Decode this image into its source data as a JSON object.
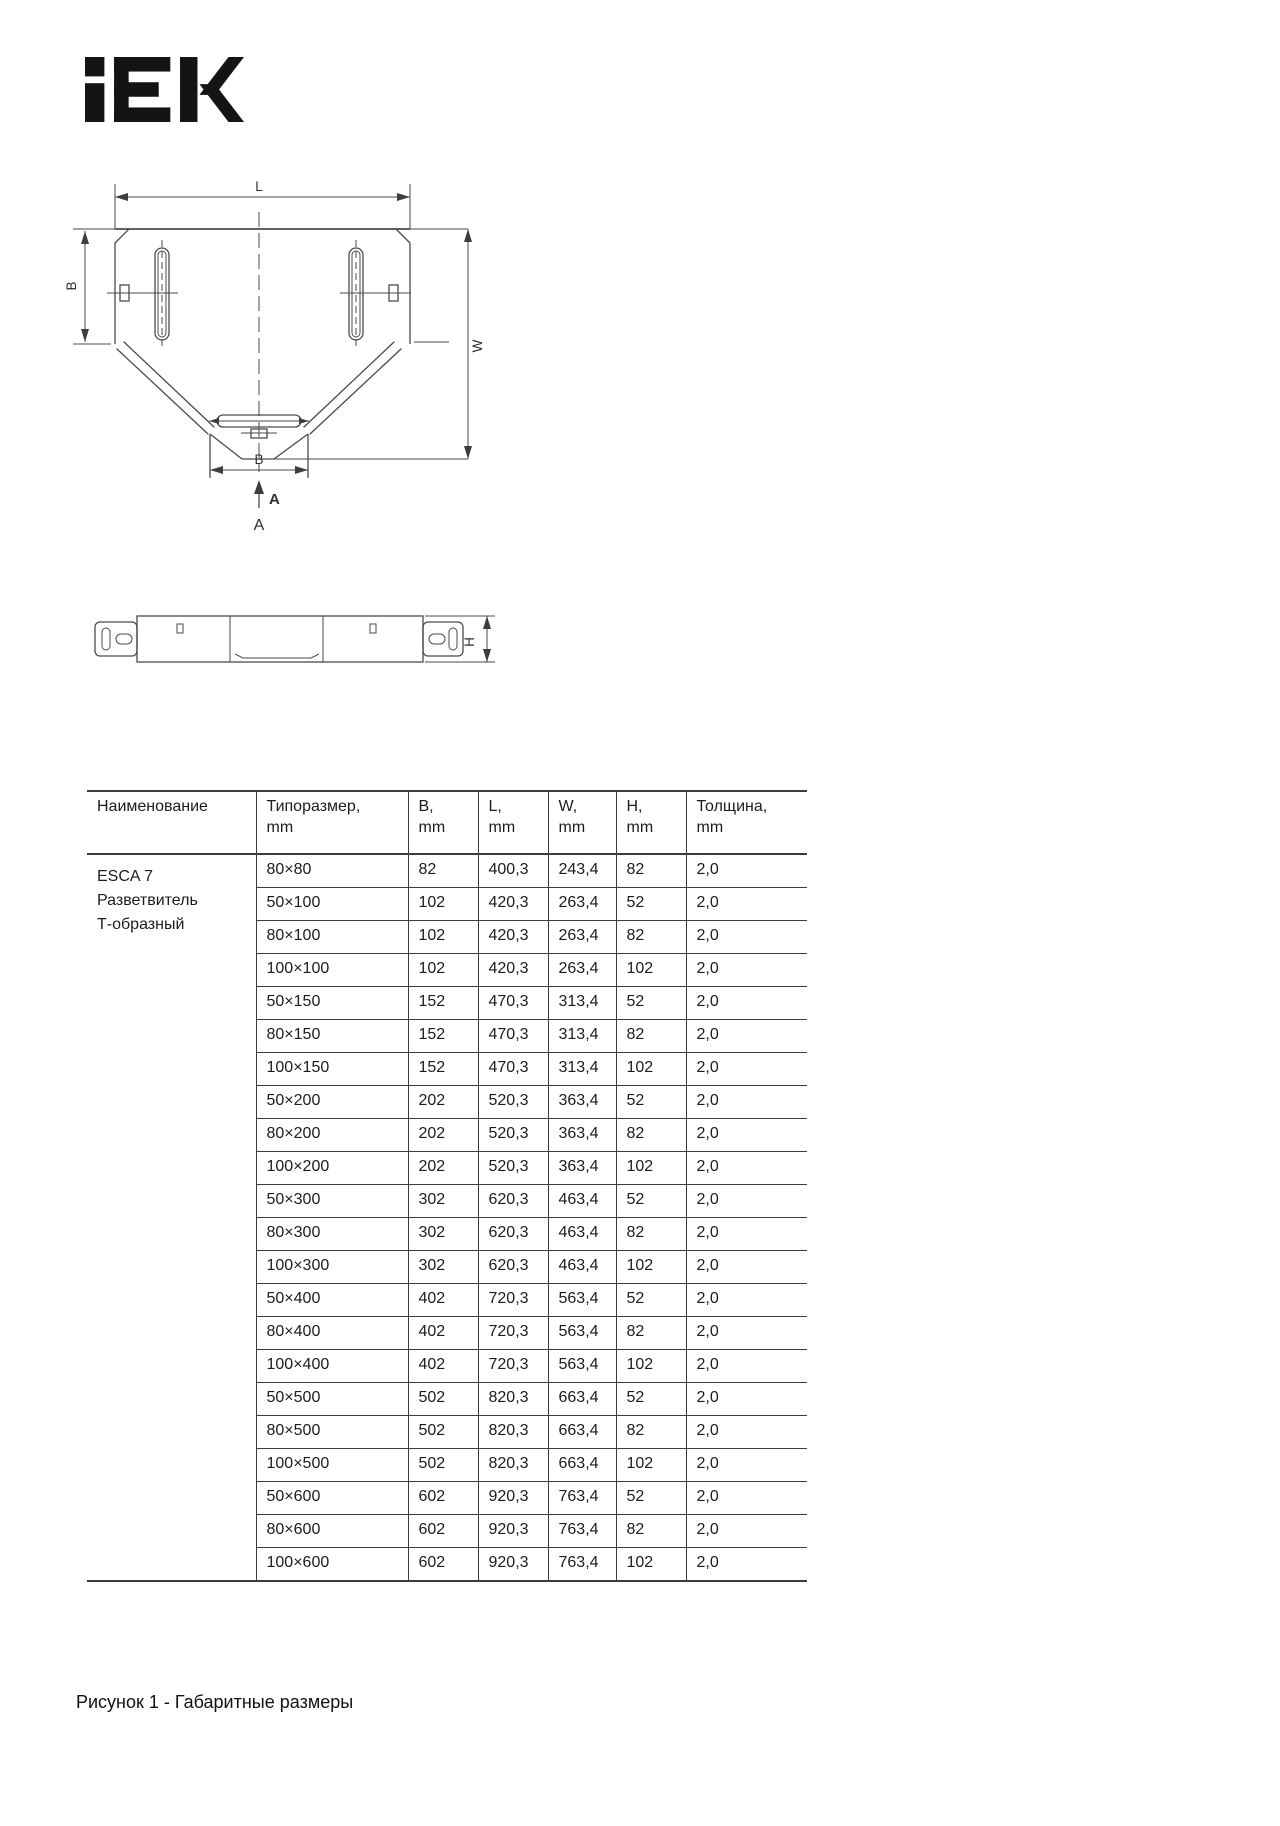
{
  "page": {
    "logo_text": "IEK",
    "caption": "Рисунок 1 - Габаритные размеры"
  },
  "drawing": {
    "labels": {
      "length": "L",
      "width_left": "B",
      "depth": "W",
      "width_bottom": "B",
      "section_arrow": "A",
      "section_title": "A",
      "height": "H"
    }
  },
  "table": {
    "headers": [
      "Наименование",
      "Типоразмер,\nmm",
      "B,\nmm",
      "L,\nmm",
      "W,\nmm",
      "H,\nmm",
      "Толщина,\nmm"
    ],
    "product_name": "ESCA 7\nРазветвитель\nТ-образный",
    "rows": [
      [
        "80×80",
        "82",
        "400,3",
        "243,4",
        "82",
        "2,0"
      ],
      [
        "50×100",
        "102",
        "420,3",
        "263,4",
        "52",
        "2,0"
      ],
      [
        "80×100",
        "102",
        "420,3",
        "263,4",
        "82",
        "2,0"
      ],
      [
        "100×100",
        "102",
        "420,3",
        "263,4",
        "102",
        "2,0"
      ],
      [
        "50×150",
        "152",
        "470,3",
        "313,4",
        "52",
        "2,0"
      ],
      [
        "80×150",
        "152",
        "470,3",
        "313,4",
        "82",
        "2,0"
      ],
      [
        "100×150",
        "152",
        "470,3",
        "313,4",
        "102",
        "2,0"
      ],
      [
        "50×200",
        "202",
        "520,3",
        "363,4",
        "52",
        "2,0"
      ],
      [
        "80×200",
        "202",
        "520,3",
        "363,4",
        "82",
        "2,0"
      ],
      [
        "100×200",
        "202",
        "520,3",
        "363,4",
        "102",
        "2,0"
      ],
      [
        "50×300",
        "302",
        "620,3",
        "463,4",
        "52",
        "2,0"
      ],
      [
        "80×300",
        "302",
        "620,3",
        "463,4",
        "82",
        "2,0"
      ],
      [
        "100×300",
        "302",
        "620,3",
        "463,4",
        "102",
        "2,0"
      ],
      [
        "50×400",
        "402",
        "720,3",
        "563,4",
        "52",
        "2,0"
      ],
      [
        "80×400",
        "402",
        "720,3",
        "563,4",
        "82",
        "2,0"
      ],
      [
        "100×400",
        "402",
        "720,3",
        "563,4",
        "102",
        "2,0"
      ],
      [
        "50×500",
        "502",
        "820,3",
        "663,4",
        "52",
        "2,0"
      ],
      [
        "80×500",
        "502",
        "820,3",
        "663,4",
        "82",
        "2,0"
      ],
      [
        "100×500",
        "502",
        "820,3",
        "663,4",
        "102",
        "2,0"
      ],
      [
        "50×600",
        "602",
        "920,3",
        "763,4",
        "52",
        "2,0"
      ],
      [
        "80×600",
        "602",
        "920,3",
        "763,4",
        "82",
        "2,0"
      ],
      [
        "100×600",
        "602",
        "920,3",
        "763,4",
        "102",
        "2,0"
      ]
    ]
  }
}
